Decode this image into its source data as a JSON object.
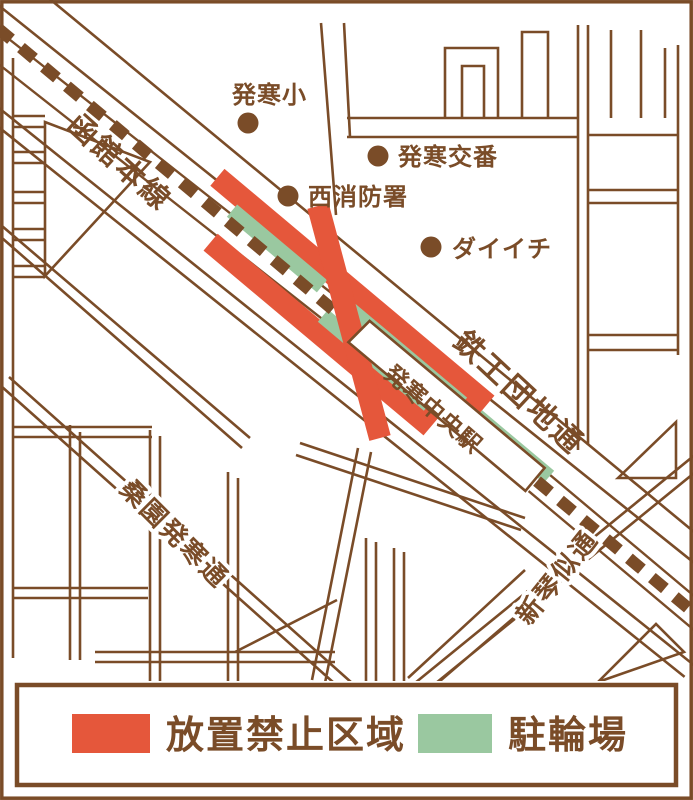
{
  "map": {
    "railway_label": "函館本線",
    "station_label": "発寒中央駅",
    "roads": {
      "tekko_danchi": "鉄工団地通",
      "soen_hassamu": "桑園発寒通",
      "shinkotoni": "新琴似通"
    },
    "pois": {
      "school": "発寒小",
      "police_box": "発寒交番",
      "fire_station": "西消防署",
      "daiichi": "ダイイチ"
    }
  },
  "legend": {
    "no_parking_label": "放置禁止区域",
    "bicycle_parking_label": "駐輪場"
  },
  "colors": {
    "brown": "#7a4c28",
    "no_parking_red": "#e5573b",
    "parking_green": "#9ac8a0",
    "background": "#ffffff"
  }
}
